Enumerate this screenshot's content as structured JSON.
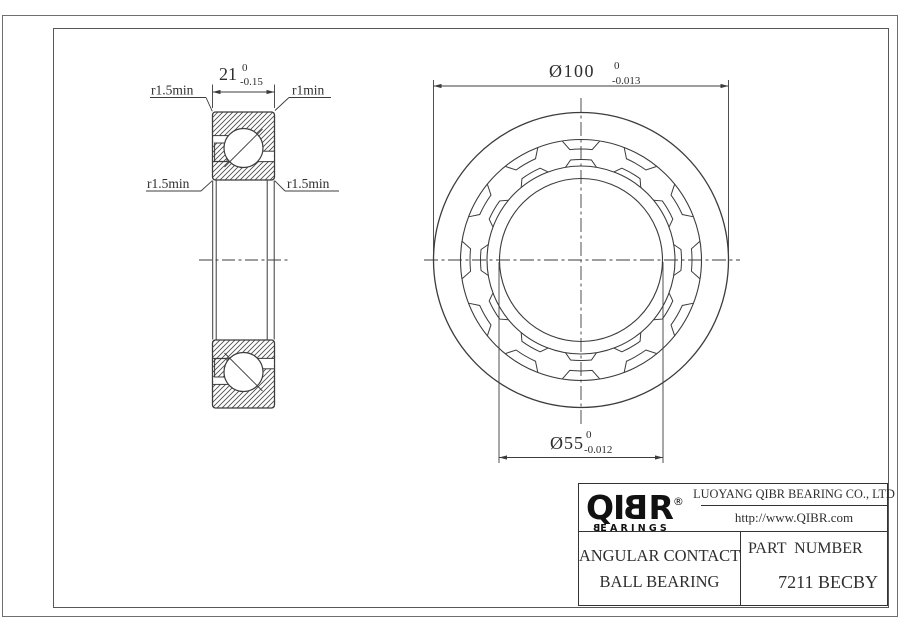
{
  "drawing": {
    "dimensions": {
      "width": {
        "nominal": "21",
        "upper": "0",
        "lower": "-0.15"
      },
      "outer_diameter": {
        "nominal": "Ø100",
        "upper": "0",
        "lower": "-0.013"
      },
      "bore_diameter": {
        "nominal": "Ø55",
        "upper": "0",
        "lower": "-0.012"
      }
    },
    "radius_labels": {
      "top_left": "r1.5min",
      "top_right": "r1min",
      "bottom_left": "r1.5min",
      "bottom_right": "r1.5min"
    }
  },
  "title_block": {
    "logo": {
      "pre": "QI",
      "flipped": "B",
      "post": "R",
      "registered": "®",
      "sub_flipped": "B",
      "sub_rest": "EARINGS"
    },
    "company": "LUOYANG QIBR BEARING CO., LTD",
    "website": "http://www.QIBR.com",
    "product_line1": "ANGULAR CONTACT",
    "product_line2": "BALL BEARING",
    "part_label": "PART  NUMBER",
    "part_number": "7211 BECBY"
  },
  "colors": {
    "line": "#3c3c3c",
    "hatch": "#4a4a4a",
    "text": "#2e2e2e",
    "frame": "#585858",
    "outer_border": "#6f6f6f"
  }
}
